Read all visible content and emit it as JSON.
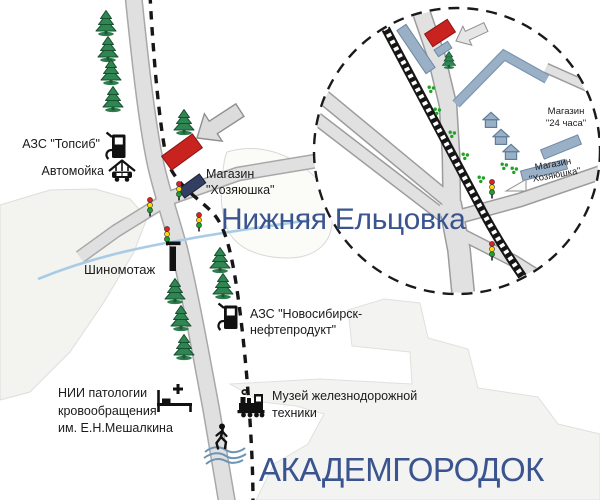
{
  "regions": {
    "nizhnyaya": "Нижняя Ельцовка",
    "akademgorodok": "АКАДЕМГОРОДОК"
  },
  "labels": {
    "azs_topsib": "АЗС \"Топсиб\"",
    "car_wash": "Автомойка",
    "shop_khoz_l1": "Магазин",
    "shop_khoz_l2": "\"Хозяюшка\"",
    "tire_service": "Шиномотаж",
    "azs_nnp_l1": "АЗС \"Новосибирск-",
    "azs_nnp_l2": "нефтепродукт\"",
    "clinic_l1": "НИИ патологии",
    "clinic_l2": "кровообращения",
    "clinic_l3": "им. Е.Н.Мешалкина",
    "museum_l1": "Музей железнодорожной",
    "museum_l2": "техники"
  },
  "inset_labels": {
    "shop24_l1": "Магазин",
    "shop24_l2": "\"24 часа\"",
    "shopkh_l1": "Магазин",
    "shopkh_l2": "\"Хозяюшка\""
  },
  "icons": {
    "fuel_pump": "fuel-pump-icon",
    "car_wash": "car-wash-icon",
    "traffic_light": "traffic-light-icon",
    "fir_tree": "fir-tree-icon",
    "bush": "bush-icon",
    "house": "house-icon",
    "direction_arrow": "direction-arrow-icon",
    "tire_sign": "tire-service-sign-icon",
    "hospital_bed": "hospital-bed-cross-icon",
    "locomotive": "steam-locomotive-icon",
    "pedestrian": "pedestrian-icon",
    "railway": "railway-track",
    "river": "river-line",
    "inset_circle": "magnifier-inset-circle"
  },
  "colors": {
    "region_label_blue": "#3a5490",
    "building_red": "#c8231f",
    "building_navy": "#323f63",
    "building_bluegray": "#9ab0c6",
    "tree_green": "#2f8653",
    "road_fill": "#e0e0e0",
    "road_border": "#a8a8a8",
    "river_blue": "#a9cce6",
    "traffic_red": "#e31f1f",
    "traffic_yellow": "#ffd800",
    "traffic_green": "#18a428"
  }
}
